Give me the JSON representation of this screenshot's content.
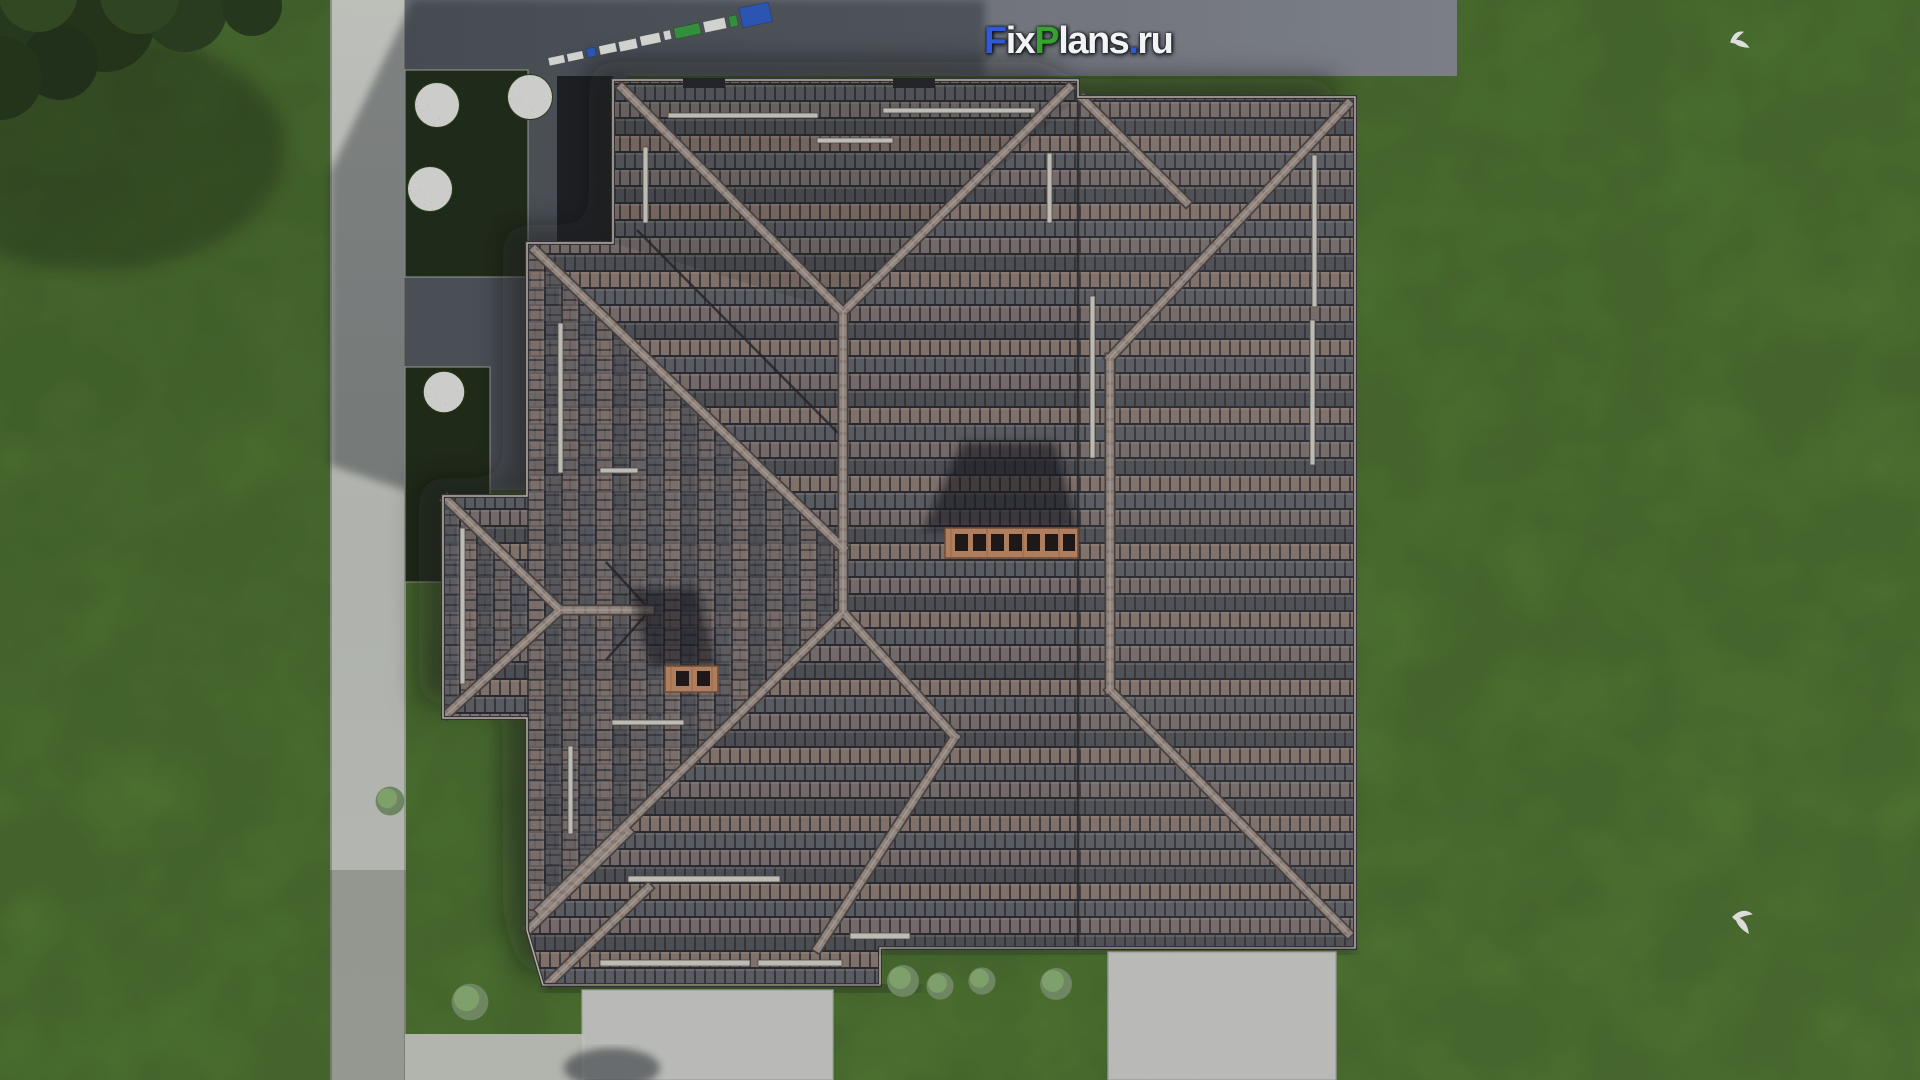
{
  "watermark_logo": {
    "text": "FixPlans.ru",
    "segments": [
      {
        "text": "F",
        "color": "#2e59d9"
      },
      {
        "text": "ix",
        "color": "#f2f3f5"
      },
      {
        "text": "P",
        "color": "#36a32c"
      },
      {
        "text": "lans",
        "color": "#f2f3f5"
      },
      {
        "text": ".",
        "color": "#2e59d9"
      },
      {
        "text": "ru",
        "color": "#f2f3f5"
      }
    ]
  },
  "scene": {
    "description": "Aerial top-down 3D render of a house with a complex tiled hip roof, lawn, concrete walkways and chimneys",
    "colors": {
      "grass": "#4e7b2b",
      "grass_dark": "#3a611f",
      "roof_tile_mauve": "#8b7970",
      "roof_tile_gray": "#5c5e66",
      "roof_tile_dark": "#4d4f57",
      "ridge_cap": "#a1928b",
      "walkway_concrete": "#cbcdc7",
      "driveway_gray": "#767b86",
      "shadow_blue": "#10141f",
      "chimney_brick": "#c68a64",
      "garden_bed_green": "#17240f",
      "tree_foliage": "#1f3513",
      "bird_white": "#ffffff",
      "scalebar_blue": "#2458c8",
      "scalebar_green": "#2f9e3a",
      "scalebar_white": "#eef0ee"
    },
    "objects": {
      "chimney_large_flue_count": 7,
      "chimney_small_flue_count": 2,
      "bird_count": 2,
      "flower_bush_count": 4,
      "green_bush_count": 6
    }
  }
}
